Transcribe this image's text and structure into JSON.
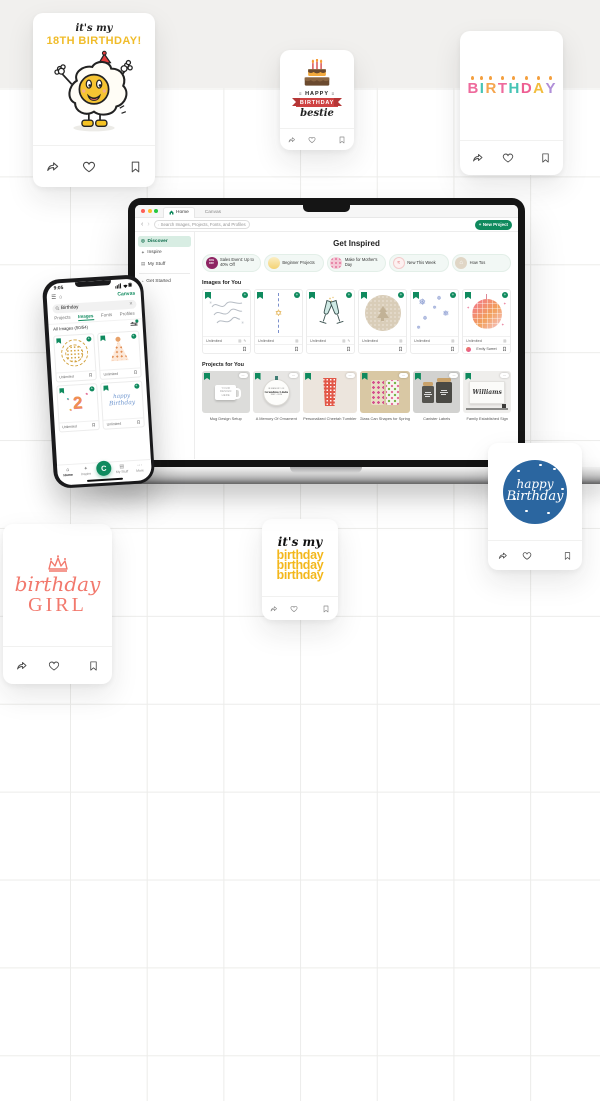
{
  "floating_cards": {
    "egg": {
      "line1": "it's my",
      "line2": "18TH BIRTHDAY!"
    },
    "bestie": {
      "word1": "HAPPY",
      "word2": "BIRTHDAY",
      "word3": "bestie"
    },
    "candles": {
      "letters": [
        "B",
        "I",
        "R",
        "T",
        "H",
        "D",
        "A",
        "Y"
      ],
      "colors": [
        "#ee6a9c",
        "#45c4b5",
        "#f5a54e",
        "#ee6a9c",
        "#45c4b5",
        "#ee5e93",
        "#f2bd3d",
        "#b08fd8"
      ],
      "flame_color": "#f49f3e"
    },
    "blue_badge": {
      "line1": "happy",
      "line2": "Birthday"
    },
    "girl": {
      "line1": "birthday",
      "line2": "GIRL"
    },
    "yellow": {
      "line1": "it's my",
      "line2": "birthday",
      "line3": "birthday",
      "line4": "birthday"
    }
  },
  "laptop": {
    "browser": {
      "tab_home": "Home",
      "tab_canvas": "Canvas",
      "search_placeholder": "Search Images, Projects, Fonts, and Profiles",
      "new_project": "New Project",
      "new_project_plus": "+"
    },
    "sidebar": {
      "items": [
        {
          "label": "Discover"
        },
        {
          "label": "Inspire"
        },
        {
          "label": "My Stuff"
        },
        {
          "label": "Get Started"
        }
      ]
    },
    "main": {
      "title": "Get Inspired",
      "chips": [
        {
          "label": "Sales Event: Up to 40% Off",
          "badge_line1": "40%",
          "badge_line2": "OFF"
        },
        {
          "label": "Beginner Projects"
        },
        {
          "label": "Make for Mother's Day"
        },
        {
          "label": "New This Week"
        },
        {
          "label": "How Tos"
        }
      ],
      "images_section": {
        "title": "Images for You",
        "item_label": "Unlimited",
        "contributor": "Emily Sweet"
      },
      "projects_section": {
        "title": "Projects for You",
        "captions": [
          "Mug Design Setup",
          "A Memory Of Ornament",
          "Personalized Cheetah Tumbler",
          "Glass Can Shapes for Spring",
          "Canister Labels",
          "Family Established Sign"
        ]
      },
      "artwork_text": {
        "mug": "YOUR DESIGN HERE",
        "ornament_line1": "IN MEMORY OF",
        "ornament_line2": "Grandma Linda",
        "ornament_line3": "1942 - 2024",
        "sign": "Williams"
      }
    }
  },
  "phone": {
    "status_time": "9:05",
    "canvas_link": "Canvas",
    "search_value": "Birthday",
    "tabs": [
      "Projects",
      "Images",
      "Fonts",
      "Profiles"
    ],
    "active_tab": "Images",
    "results_label": "All Images (50/54)",
    "item_label": "Unlimited",
    "nav": [
      "Home",
      "Inspire",
      "My Stuff",
      "More"
    ],
    "fab_glyph": "C"
  },
  "colors": {
    "brand_green": "#0f8a5e",
    "mint": "#d8ede3",
    "band": "#f1f0ee"
  }
}
